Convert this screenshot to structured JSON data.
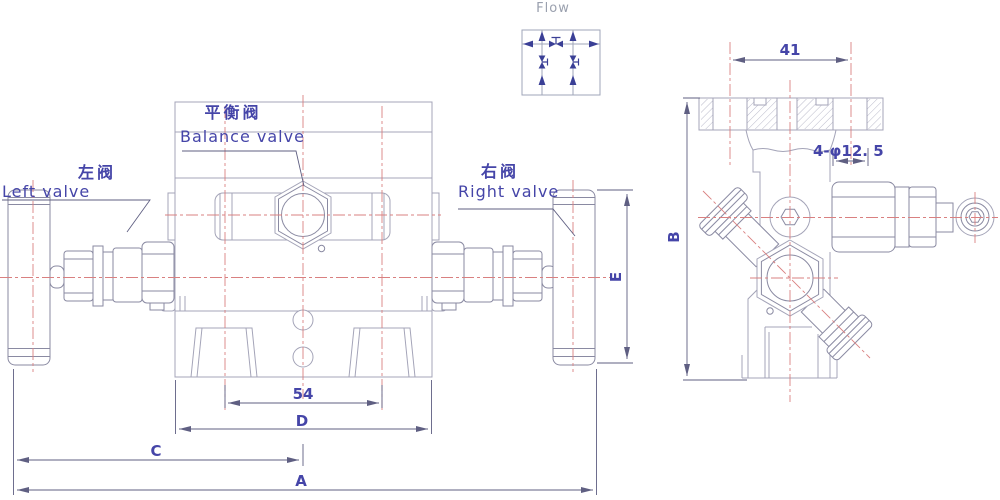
{
  "labels": {
    "flow": "Flow",
    "balance_valve_cn": "平衡阀",
    "balance_valve_en": "Balance valve",
    "left_valve_cn": "左阀",
    "left_valve_en": "Left valve",
    "right_valve_cn": "右阀",
    "right_valve_en": "Right valve"
  },
  "dimensions": {
    "flange_hole_spacing": "41",
    "bolt_holes": "4-φ12. 5",
    "foot_spacing": "54",
    "overall_width": "A",
    "side_height": "B",
    "center_offset": "C",
    "body_width": "D",
    "handle_height": "E"
  },
  "colors": {
    "body_line": "#a4a4b8",
    "part_line": "#8a8aa2",
    "centerline_red": "#d98080",
    "dimension_line": "#5f5f82",
    "label_text": "#4545a8",
    "schematic_navy": "#3a3f96"
  }
}
